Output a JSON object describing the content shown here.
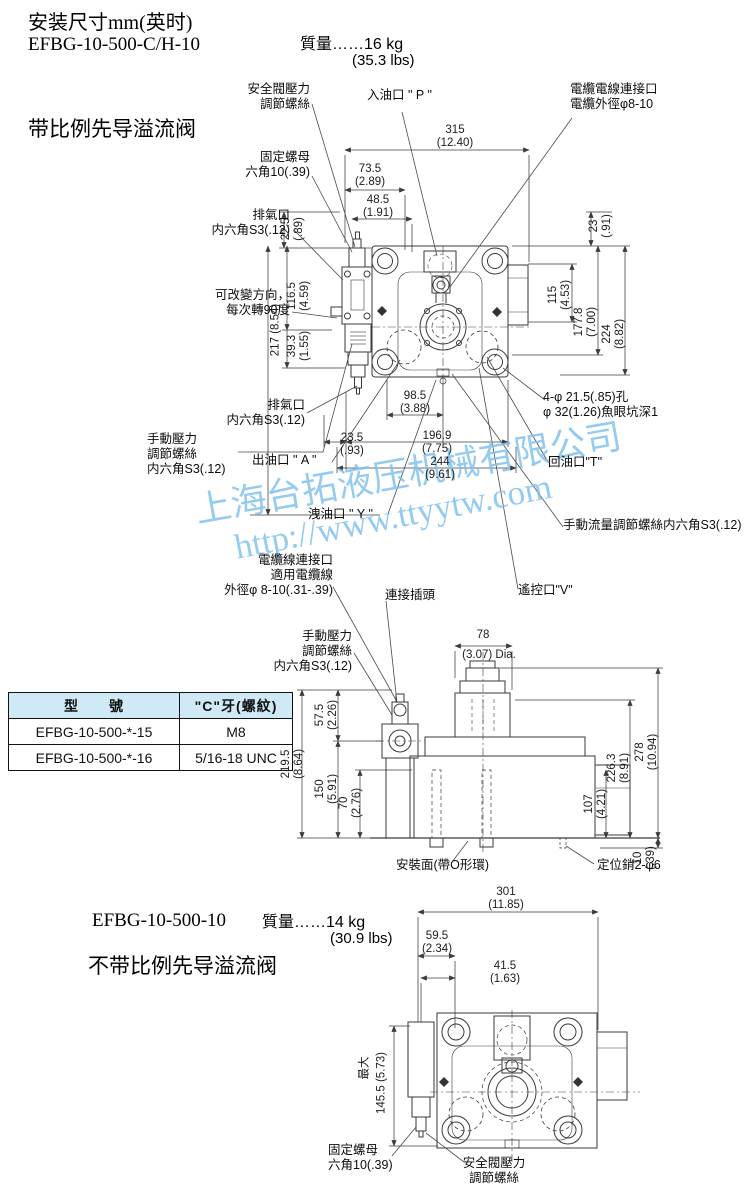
{
  "header": {
    "title": "安装尺寸mm(英时)",
    "model": "EFBG-10-500-C/H-10",
    "weight": "質量……16 kg",
    "weight_lbs": "(35.3 lbs)",
    "valve_name": "带比例先导溢流阀"
  },
  "watermark": {
    "company": "上海台拓液压机械有限公司",
    "url": "http://www.ttyytw.com",
    "color": "#7cbfeb"
  },
  "d1": {
    "labels": {
      "safety": "安全閥壓力\n調節螺絲",
      "inlet_p": "入油口 \" P \"",
      "cable_top": "電纜電線連接口\n電纜外徑φ8-10",
      "locknut": "固定螺母\n六角10(.39)",
      "vent_top": "排氣口\n内六角S3(.12)",
      "rotate": "可改變方向，\n每次轉90度",
      "vent_bottom": "排氣口\n内六角S3(.12)",
      "manual_pressure": "手動壓力\n調節螺絲\n内六角S3(.12)",
      "outlet_a": "出油口 \" A \"",
      "drain_y": "洩油口 \" Y \"",
      "holes": "4-φ 21.5(.85)孔\nφ 32(1.26)魚眼坑深1",
      "return_t": "回油口\"T\"",
      "flow_screw": "手動流量調節螺絲内六角S3(.12)",
      "remote_v": "遙控口\"V\"",
      "cable_bottom": "電纜線連接口\n適用電纜線\n外徑φ 8-10(.31-.39)",
      "plug": "連接插頭",
      "manual_pressure2": "手動壓力\n調節螺絲\n内六角S3(.12)"
    },
    "dims": {
      "w315": "315\n(12.40)",
      "w735": "73.5\n(2.89)",
      "w485": "48.5\n(1.91)",
      "h225": "22.5\n(.89)",
      "h217": "217 (8.54)",
      "h1165": "116.5\n(4.59)",
      "h393": "39.3\n(1.55)",
      "h23": "23\n(.91)",
      "h115": "115\n(4.53)",
      "h1778": "177.8\n(7.00)",
      "h224": "224\n(8.82)",
      "w985": "98.5\n(3.88)",
      "w235": "23.5\n(.93)",
      "w1969": "196.9\n(7.75)",
      "w244": "244\n(9.61)"
    }
  },
  "d2": {
    "labels": {
      "mounting_face": "安裝面(帶O形環)",
      "locating_pin": "定位銷2-φ6"
    },
    "dims": {
      "w78": "78",
      "w78in": "(3.07) Dia.",
      "h575": "57.5\n(2.26)",
      "h2195": "219.5\n(8.64)",
      "h150": "150\n(5.91)",
      "h70": "70\n(2.76)",
      "h2263": "226.3\n(8.91)",
      "h278": "278\n(10.94)",
      "h107": "107\n(4.21)",
      "h10": "10\n(.39)"
    }
  },
  "table": {
    "col_model": "型　　號",
    "col_thread": "\"C\"牙(螺紋)",
    "rows": [
      {
        "model": "EFBG-10-500-*-15",
        "thread": "M8"
      },
      {
        "model": "EFBG-10-500-*-16",
        "thread": "5/16-18 UNC"
      }
    ],
    "header_bg": "#cfe9f6"
  },
  "d3": {
    "model": "EFBG-10-500-10",
    "weight": "質量……14 kg",
    "weight_lbs": "(30.9 lbs)",
    "valve_name": "不带比例先导溢流阀",
    "labels": {
      "locknut": "固定螺母\n六角10(.39)",
      "safety": "安全閥壓力\n調節螺絲"
    },
    "dims": {
      "w301": "301\n(11.85)",
      "w595": "59.5\n(2.34)",
      "w415": "41.5\n(1.63)",
      "max": "最大",
      "h1455": "145.5 (5.73)"
    }
  }
}
